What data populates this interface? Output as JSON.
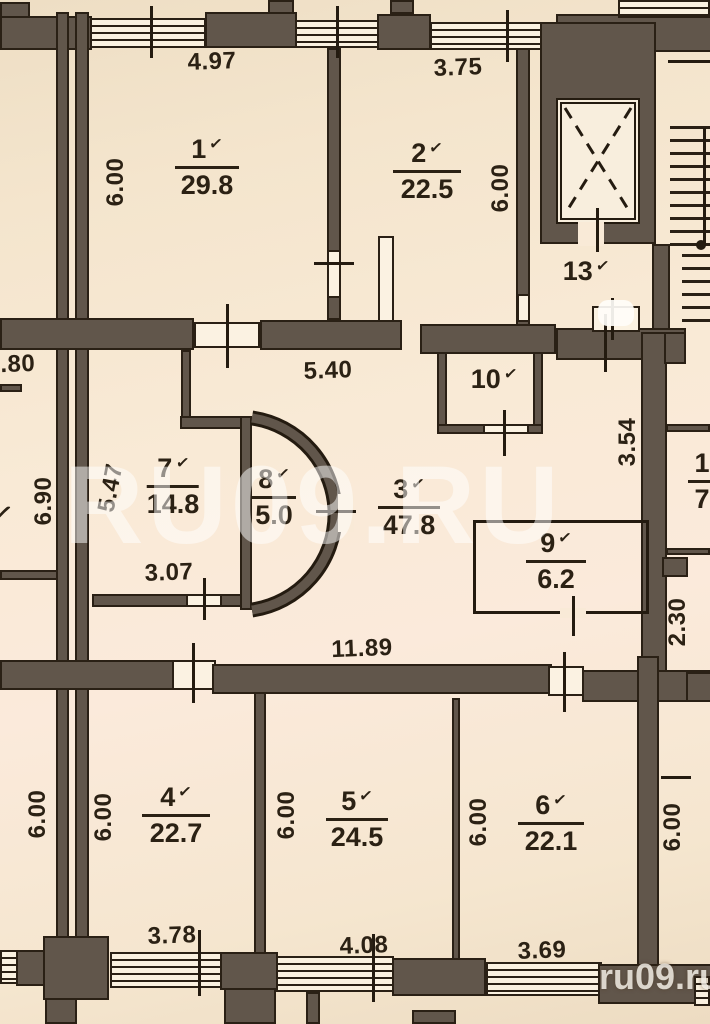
{
  "watermarks": {
    "center": "RU09.RU",
    "corner": "ru09.ru"
  },
  "colors": {
    "paper": "#f9ead7",
    "wall": "#61564b",
    "line": "#2a2015",
    "text": "#2b2114",
    "watermark": "rgba(255,255,255,0.5)"
  },
  "rooms": [
    {
      "number": "1",
      "check": "✓",
      "area": "29.8"
    },
    {
      "number": "2",
      "check": "✓",
      "area": "22.5"
    },
    {
      "number": "3",
      "check": "✓",
      "area": "47.8"
    },
    {
      "number": "4",
      "check": "✓",
      "area": "22.7"
    },
    {
      "number": "5",
      "check": "✓",
      "area": "24.5"
    },
    {
      "number": "6",
      "check": "✓",
      "area": "22.1"
    },
    {
      "number": "7",
      "check": "✓",
      "area": "14.8"
    },
    {
      "number": "8",
      "check": "✓",
      "area": "5.0"
    },
    {
      "number": "9",
      "check": "✓",
      "area": "6.2"
    },
    {
      "number": "10",
      "check": "✓"
    },
    {
      "number": "13",
      "check": "✓"
    }
  ],
  "partial_room": {
    "number": "1",
    "area": "7"
  },
  "left_edge_check": "✓",
  "dimensions": [
    "4.97",
    "3.75",
    "6.00",
    "6.00",
    "11.80",
    "5.40",
    "3.54",
    "6.90",
    "5.47",
    "3.07",
    "2.30",
    "11.89",
    "6.00",
    "6.00",
    "6.00",
    "6.00",
    "6.00",
    "3.78",
    "4.08",
    "3.69"
  ]
}
